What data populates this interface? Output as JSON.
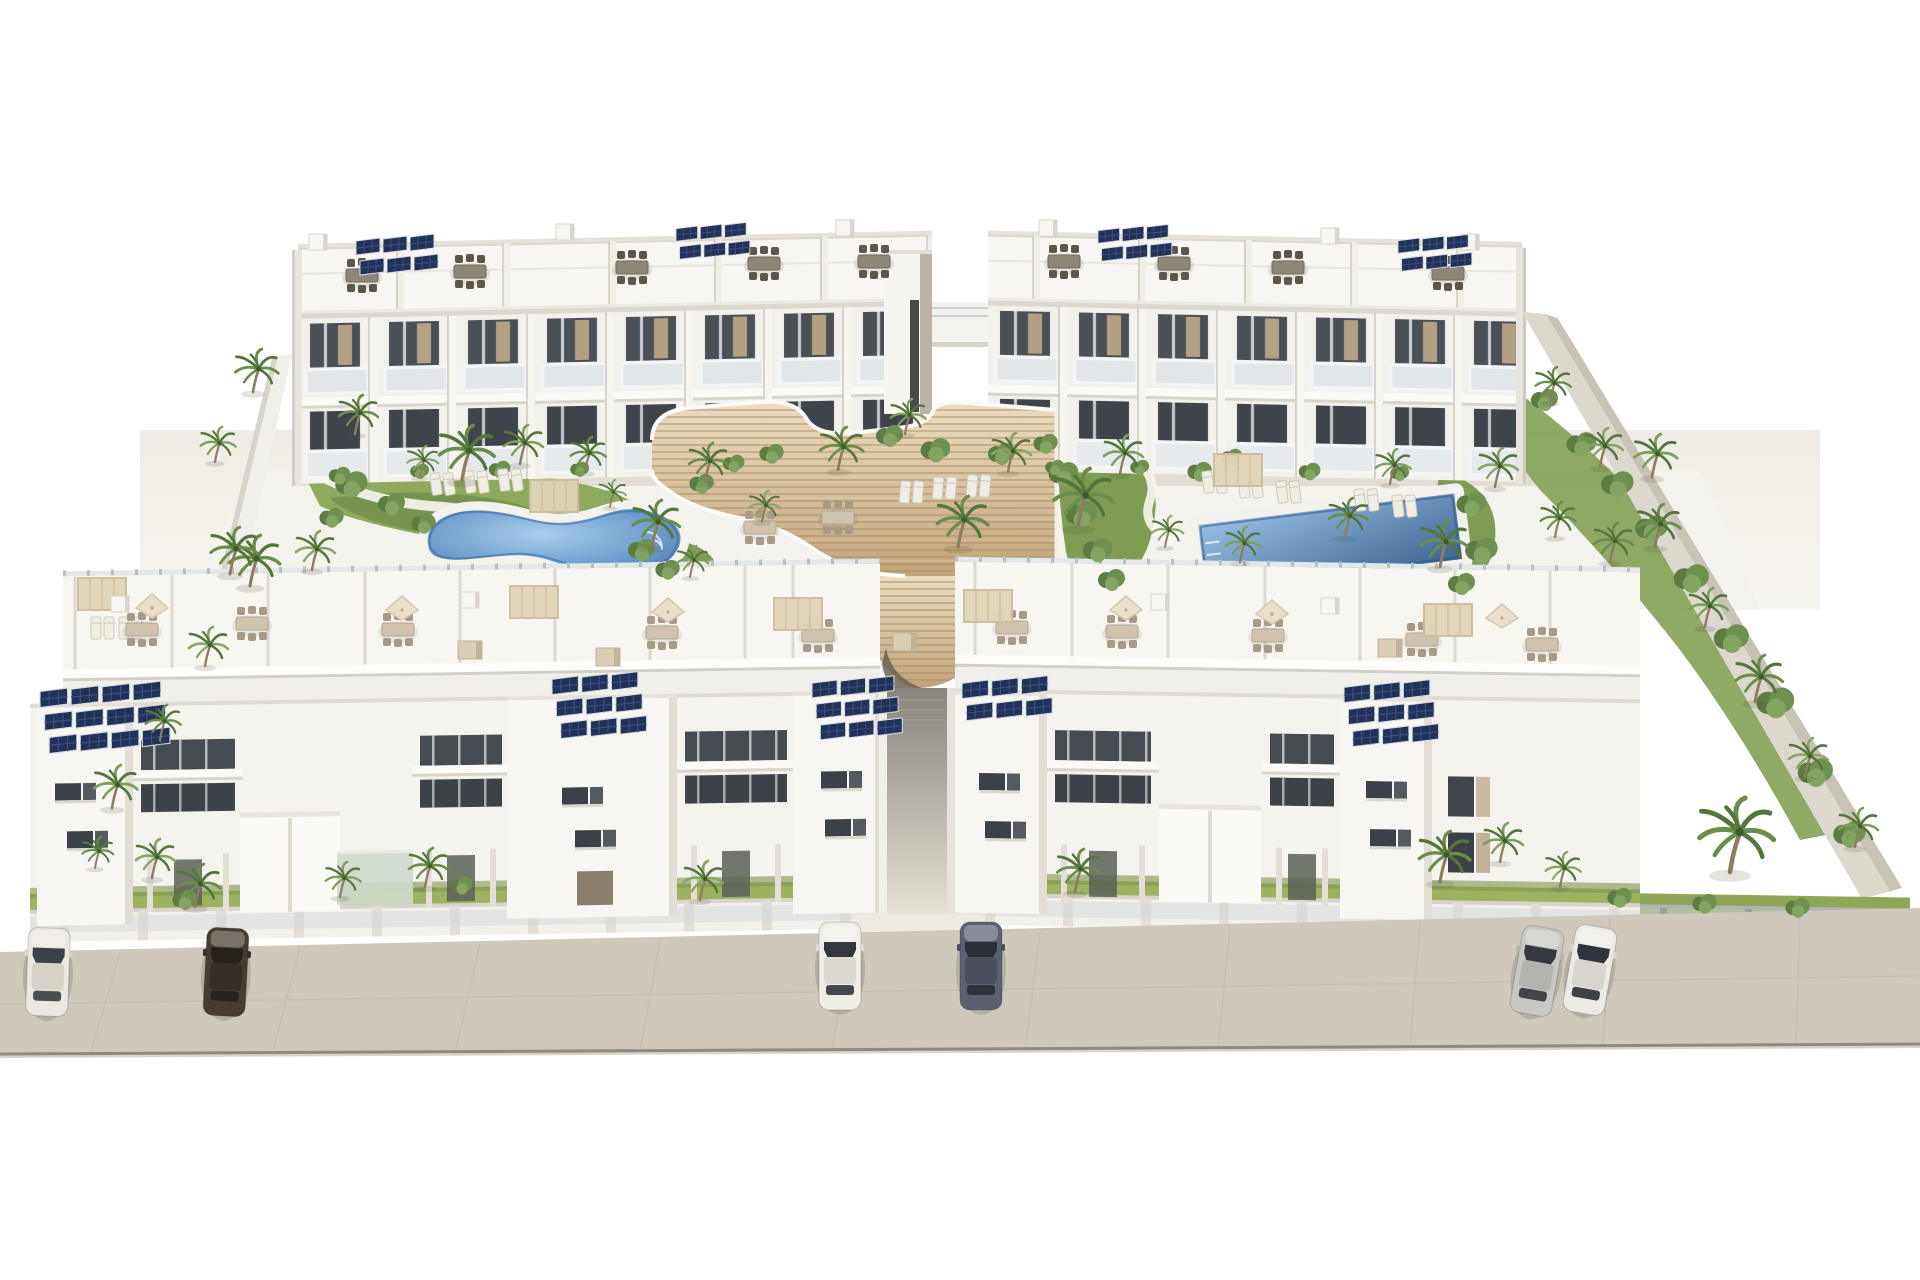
{
  "meta": {
    "description": "Aerial 3D architectural rendering of a white apartment complex with two back blocks, two front blocks, central wooden amphitheater stairs, two swimming pools, palm garden and street parking",
    "visible_text": []
  },
  "palette": {
    "sky": "#ffffff",
    "wall_white": "#f6f4f0",
    "wall_shade": "#e7e4dd",
    "wall_dark_face": "#d8d4cb",
    "opening_dark": "#41464c",
    "glass_rail": "#dfe4e6",
    "wood_light": "#e9d9bc",
    "wood_dark": "#c4a67e",
    "wood_line": "#a98f69",
    "pool_light": "#a9cdec",
    "pool_deep": "#41699b",
    "road": "#cfc8bc",
    "road_edge": "#8f8a80",
    "grass": "#97ad5e",
    "palm_green": "#6b8d4c",
    "palm_dark": "#55763b",
    "solar_panel": "#223257",
    "solar_grid": "#3c4f86"
  },
  "scene": {
    "cars": [
      {
        "name": "white-sedan-far-left",
        "x": 48,
        "y": 972,
        "rot": 2,
        "body": "#ece8e0",
        "roof": "#d6d2c8",
        "glass": "#3c4147"
      },
      {
        "name": "dark-brown-sedan-left",
        "x": 226,
        "y": 972,
        "rot": 3,
        "body": "#463c33",
        "roof": "#352d26",
        "glass": "#26211c"
      },
      {
        "name": "white-sedan-center",
        "x": 840,
        "y": 966,
        "rot": 0,
        "body": "#f0ede7",
        "roof": "#dcd8d0",
        "glass": "#34383e"
      },
      {
        "name": "slate-blue-sedan-center",
        "x": 981,
        "y": 966,
        "rot": 0,
        "body": "#5a6170",
        "roof": "#49505e",
        "glass": "#2b2f36"
      },
      {
        "name": "silver-sedan-right",
        "x": 1537,
        "y": 971,
        "rot": 10,
        "body": "#c9c8c4",
        "roof": "#b4b3af",
        "glass": "#35393f"
      },
      {
        "name": "white-sedan-right",
        "x": 1590,
        "y": 970,
        "rot": 10,
        "body": "#eceae5",
        "roof": "#d8d5cf",
        "glass": "#2f333a"
      }
    ],
    "solar_arrays": [
      {
        "x": 356,
        "y": 238,
        "cols": 3,
        "rows": 2,
        "s": 1.0
      },
      {
        "x": 676,
        "y": 226,
        "cols": 3,
        "rows": 2,
        "s": 0.9
      },
      {
        "x": 1098,
        "y": 228,
        "cols": 3,
        "rows": 2,
        "s": 0.9
      },
      {
        "x": 1398,
        "y": 238,
        "cols": 3,
        "rows": 2,
        "s": 0.9
      },
      {
        "x": 40,
        "y": 688,
        "cols": 4,
        "rows": 3,
        "s": 1.15
      },
      {
        "x": 552,
        "y": 676,
        "cols": 3,
        "rows": 3,
        "s": 1.1
      },
      {
        "x": 812,
        "y": 680,
        "cols": 3,
        "rows": 3,
        "s": 1.05
      },
      {
        "x": 962,
        "y": 680,
        "cols": 3,
        "rows": 2,
        "s": 1.1
      },
      {
        "x": 1344,
        "y": 684,
        "cols": 3,
        "rows": 3,
        "s": 1.1
      }
    ],
    "roof_furniture_dark": [
      {
        "x": 362,
        "y": 276
      },
      {
        "x": 470,
        "y": 272
      },
      {
        "x": 632,
        "y": 268
      },
      {
        "x": 764,
        "y": 264
      },
      {
        "x": 874,
        "y": 262
      },
      {
        "x": 1064,
        "y": 262
      },
      {
        "x": 1174,
        "y": 264
      },
      {
        "x": 1288,
        "y": 268
      },
      {
        "x": 1448,
        "y": 274
      }
    ],
    "roof_furniture_light": [
      {
        "x": 142,
        "y": 630
      },
      {
        "x": 252,
        "y": 624
      },
      {
        "x": 398,
        "y": 630
      },
      {
        "x": 662,
        "y": 633
      },
      {
        "x": 818,
        "y": 636
      },
      {
        "x": 1012,
        "y": 628
      },
      {
        "x": 1122,
        "y": 632
      },
      {
        "x": 1268,
        "y": 636
      },
      {
        "x": 1422,
        "y": 640
      },
      {
        "x": 1542,
        "y": 645
      },
      {
        "x": 838,
        "y": 518
      },
      {
        "x": 760,
        "y": 528
      }
    ],
    "parasols": [
      {
        "x": 152,
        "y": 608
      },
      {
        "x": 402,
        "y": 610
      },
      {
        "x": 668,
        "y": 612
      },
      {
        "x": 1126,
        "y": 610
      },
      {
        "x": 1272,
        "y": 614
      },
      {
        "x": 1502,
        "y": 618
      }
    ],
    "pergolas": [
      {
        "x": 102,
        "y": 594
      },
      {
        "x": 534,
        "y": 602
      },
      {
        "x": 798,
        "y": 614
      },
      {
        "x": 988,
        "y": 606
      },
      {
        "x": 1448,
        "y": 620
      },
      {
        "x": 554,
        "y": 496
      },
      {
        "x": 1238,
        "y": 470
      }
    ],
    "roof_boxes_white": [
      {
        "x": 318,
        "y": 242
      },
      {
        "x": 565,
        "y": 232
      },
      {
        "x": 845,
        "y": 228
      },
      {
        "x": 1048,
        "y": 228
      },
      {
        "x": 1330,
        "y": 236
      },
      {
        "x": 1470,
        "y": 242
      },
      {
        "x": 120,
        "y": 604
      },
      {
        "x": 470,
        "y": 600
      },
      {
        "x": 1160,
        "y": 602
      },
      {
        "x": 1330,
        "y": 606
      }
    ],
    "roof_boxes_tan": [
      {
        "x": 470,
        "y": 650
      },
      {
        "x": 608,
        "y": 657
      },
      {
        "x": 905,
        "y": 642
      },
      {
        "x": 1390,
        "y": 648
      }
    ],
    "loungers": [
      {
        "x": 96,
        "y": 628,
        "rot": 0
      },
      {
        "x": 124,
        "y": 628,
        "rot": 0
      },
      {
        "x": 436,
        "y": 484,
        "rot": -8
      },
      {
        "x": 470,
        "y": 482,
        "rot": -8
      },
      {
        "x": 504,
        "y": 480,
        "rot": -8
      },
      {
        "x": 905,
        "y": 492,
        "rot": 5
      },
      {
        "x": 938,
        "y": 488,
        "rot": 5
      },
      {
        "x": 972,
        "y": 486,
        "rot": 5
      },
      {
        "x": 1208,
        "y": 482,
        "rot": -7
      },
      {
        "x": 1244,
        "y": 487,
        "rot": -7
      },
      {
        "x": 1282,
        "y": 492,
        "rot": -7
      },
      {
        "x": 1360,
        "y": 500,
        "rot": -7
      },
      {
        "x": 1398,
        "y": 506,
        "rot": -7
      }
    ],
    "bushes": [
      {
        "x": 890,
        "y": 434,
        "s": 1.0
      },
      {
        "x": 936,
        "y": 448,
        "s": 1.1
      },
      {
        "x": 1002,
        "y": 452,
        "s": 1.0
      },
      {
        "x": 1046,
        "y": 442,
        "s": 0.9
      },
      {
        "x": 1064,
        "y": 472,
        "s": 1.1
      },
      {
        "x": 1082,
        "y": 512,
        "s": 1.2
      },
      {
        "x": 1098,
        "y": 548,
        "s": 1.1
      },
      {
        "x": 1112,
        "y": 578,
        "s": 1.0
      },
      {
        "x": 1200,
        "y": 470,
        "s": 0.9
      },
      {
        "x": 1232,
        "y": 456,
        "s": 0.8
      },
      {
        "x": 1472,
        "y": 502,
        "s": 1.1
      },
      {
        "x": 1482,
        "y": 548,
        "s": 1.2
      },
      {
        "x": 1462,
        "y": 582,
        "s": 1.0
      },
      {
        "x": 352,
        "y": 482,
        "s": 1.2
      },
      {
        "x": 392,
        "y": 502,
        "s": 1.0
      },
      {
        "x": 424,
        "y": 522,
        "s": 0.9
      },
      {
        "x": 332,
        "y": 516,
        "s": 0.9
      },
      {
        "x": 642,
        "y": 548,
        "s": 1.0
      },
      {
        "x": 668,
        "y": 568,
        "s": 0.9
      },
      {
        "x": 702,
        "y": 482,
        "s": 0.9
      },
      {
        "x": 734,
        "y": 462,
        "s": 0.8
      },
      {
        "x": 772,
        "y": 452,
        "s": 0.9
      },
      {
        "x": 1545,
        "y": 398,
        "s": 1.0
      },
      {
        "x": 1582,
        "y": 442,
        "s": 1.1
      },
      {
        "x": 1618,
        "y": 482,
        "s": 1.2
      },
      {
        "x": 1652,
        "y": 526,
        "s": 1.2
      },
      {
        "x": 1692,
        "y": 576,
        "s": 1.3
      },
      {
        "x": 1732,
        "y": 636,
        "s": 1.3
      },
      {
        "x": 1776,
        "y": 700,
        "s": 1.4
      },
      {
        "x": 1816,
        "y": 770,
        "s": 1.3
      },
      {
        "x": 1850,
        "y": 832,
        "s": 1.2
      },
      {
        "x": 340,
        "y": 474,
        "s": 0.8
      },
      {
        "x": 420,
        "y": 470,
        "s": 0.7
      },
      {
        "x": 500,
        "y": 468,
        "s": 0.8
      },
      {
        "x": 580,
        "y": 468,
        "s": 0.7
      },
      {
        "x": 1055,
        "y": 466,
        "s": 0.7
      },
      {
        "x": 1140,
        "y": 466,
        "s": 0.7
      },
      {
        "x": 1310,
        "y": 470,
        "s": 0.8
      },
      {
        "x": 1400,
        "y": 472,
        "s": 0.7
      },
      {
        "x": 185,
        "y": 898,
        "s": 0.9
      },
      {
        "x": 462,
        "y": 884,
        "s": 0.8
      },
      {
        "x": 1620,
        "y": 896,
        "s": 0.9
      },
      {
        "x": 1705,
        "y": 902,
        "s": 0.9
      },
      {
        "x": 1798,
        "y": 906,
        "s": 0.9
      }
    ],
    "palms": [
      {
        "x": 253,
        "y": 392,
        "s": 1.1,
        "c": "#6b8d4c"
      },
      {
        "x": 215,
        "y": 462,
        "s": 0.9,
        "c": "#7d9f5c"
      },
      {
        "x": 250,
        "y": 586,
        "s": 1.3,
        "c": "#6b8d4c"
      },
      {
        "x": 205,
        "y": 666,
        "s": 1.0,
        "c": "#86a763"
      },
      {
        "x": 160,
        "y": 740,
        "s": 0.9,
        "c": "#6b8d4c"
      },
      {
        "x": 112,
        "y": 808,
        "s": 1.1,
        "c": "#7d9f5c"
      },
      {
        "x": 95,
        "y": 868,
        "s": 0.8,
        "c": "#6b8d4c"
      },
      {
        "x": 152,
        "y": 878,
        "s": 1.0,
        "c": "#86a763"
      },
      {
        "x": 355,
        "y": 434,
        "s": 1.0,
        "c": "#6b8d4c"
      },
      {
        "x": 420,
        "y": 477,
        "s": 0.8,
        "c": "#86a763"
      },
      {
        "x": 462,
        "y": 480,
        "s": 1.4,
        "c": "#6b8d4c"
      },
      {
        "x": 520,
        "y": 464,
        "s": 1.0,
        "c": "#7d9f5c"
      },
      {
        "x": 585,
        "y": 472,
        "s": 0.9,
        "c": "#6b8d4c"
      },
      {
        "x": 610,
        "y": 507,
        "s": 0.7,
        "c": "#86a763"
      },
      {
        "x": 652,
        "y": 547,
        "s": 1.2,
        "c": "#6b8d4c"
      },
      {
        "x": 690,
        "y": 577,
        "s": 0.8,
        "c": "#7d9f5c"
      },
      {
        "x": 705,
        "y": 482,
        "s": 1.0,
        "c": "#6b8d4c"
      },
      {
        "x": 762,
        "y": 522,
        "s": 0.8,
        "c": "#86a763"
      },
      {
        "x": 838,
        "y": 470,
        "s": 1.1,
        "c": "#6b8d4c"
      },
      {
        "x": 905,
        "y": 434,
        "s": 0.9,
        "c": "#7d9f5c"
      },
      {
        "x": 958,
        "y": 547,
        "s": 1.3,
        "c": "#6b8d4c"
      },
      {
        "x": 1008,
        "y": 472,
        "s": 1.0,
        "c": "#86a763"
      },
      {
        "x": 1078,
        "y": 527,
        "s": 1.5,
        "c": "#6b8d4c"
      },
      {
        "x": 1120,
        "y": 474,
        "s": 1.0,
        "c": "#7d9f5c"
      },
      {
        "x": 1165,
        "y": 547,
        "s": 0.8,
        "c": "#86a763"
      },
      {
        "x": 1345,
        "y": 537,
        "s": 1.0,
        "c": "#6b8d4c"
      },
      {
        "x": 1390,
        "y": 484,
        "s": 0.9,
        "c": "#7d9f5c"
      },
      {
        "x": 1440,
        "y": 567,
        "s": 1.2,
        "c": "#6b8d4c"
      },
      {
        "x": 1495,
        "y": 487,
        "s": 1.0,
        "c": "#86a763"
      },
      {
        "x": 1555,
        "y": 537,
        "s": 0.9,
        "c": "#6b8d4c"
      },
      {
        "x": 1652,
        "y": 477,
        "s": 1.1,
        "c": "#7d9f5c"
      },
      {
        "x": 1550,
        "y": 402,
        "s": 0.9,
        "c": "#6b8d4c"
      },
      {
        "x": 1600,
        "y": 467,
        "s": 1.0,
        "c": "#86a763"
      },
      {
        "x": 1655,
        "y": 547,
        "s": 1.1,
        "c": "#6b8d4c"
      },
      {
        "x": 1705,
        "y": 627,
        "s": 1.0,
        "c": "#7d9f5c"
      },
      {
        "x": 1755,
        "y": 702,
        "s": 1.2,
        "c": "#6b8d4c"
      },
      {
        "x": 1805,
        "y": 777,
        "s": 1.0,
        "c": "#86a763"
      },
      {
        "x": 1730,
        "y": 872,
        "s": 1.9,
        "c": "#6b8d4c"
      },
      {
        "x": 1855,
        "y": 847,
        "s": 1.0,
        "c": "#7d9f5c"
      },
      {
        "x": 195,
        "y": 907,
        "s": 1.1,
        "c": "#6b8d4c"
      },
      {
        "x": 340,
        "y": 897,
        "s": 0.9,
        "c": "#7d9f5c"
      },
      {
        "x": 425,
        "y": 887,
        "s": 1.0,
        "c": "#6b8d4c"
      },
      {
        "x": 700,
        "y": 900,
        "s": 1.0,
        "c": "#86a763"
      },
      {
        "x": 1075,
        "y": 892,
        "s": 1.1,
        "c": "#6b8d4c"
      },
      {
        "x": 1440,
        "y": 882,
        "s": 1.3,
        "c": "#6b8d4c"
      },
      {
        "x": 1500,
        "y": 862,
        "s": 1.0,
        "c": "#7d9f5c"
      },
      {
        "x": 1560,
        "y": 887,
        "s": 0.9,
        "c": "#86a763"
      },
      {
        "x": 230,
        "y": 574,
        "s": 1.2,
        "c": "#6b8d4c"
      },
      {
        "x": 312,
        "y": 570,
        "s": 1.0,
        "c": "#86a763"
      },
      {
        "x": 1240,
        "y": 562,
        "s": 0.9,
        "c": "#7d9f5c"
      },
      {
        "x": 1610,
        "y": 562,
        "s": 1.0,
        "c": "#6b8d4c"
      }
    ],
    "front_facade_left": {
      "towers": [
        {
          "x": 37,
          "w": 96,
          "win": [
            [
              18,
              770
            ],
            [
              30,
              818
            ]
          ]
        },
        {
          "x": 507,
          "w": 170,
          "win": [
            [
              55,
              782
            ],
            [
              68,
              825
            ]
          ],
          "door": {
            "dx": 70,
            "dy": 866,
            "w": 36,
            "h": 34
          }
        },
        {
          "x": 793,
          "w": 90,
          "win": [
            [
              28,
              770
            ],
            [
              32,
              818
            ]
          ]
        }
      ],
      "bands": [
        {
          "x": 133,
          "w": 110
        },
        {
          "x": 412,
          "w": 98
        },
        {
          "x": 677,
          "w": 118
        }
      ],
      "boxes": [
        {
          "x": 240,
          "w": 100,
          "y": 802,
          "h": 100
        },
        {
          "x": 337,
          "w": 76,
          "y": 842,
          "h": 54,
          "glass": true
        }
      ]
    },
    "front_facade_right": {
      "towers": [
        {
          "x": 955,
          "w": 92,
          "win": [
            [
              24,
              772
            ],
            [
              30,
              820
            ]
          ]
        },
        {
          "x": 1340,
          "w": 92,
          "win": [
            [
              26,
              774
            ],
            [
              30,
              822
            ]
          ]
        }
      ],
      "bands": [
        {
          "x": 1047,
          "w": 112
        },
        {
          "x": 1262,
          "w": 80
        }
      ],
      "boxes": [
        {
          "x": 1159,
          "w": 102,
          "y": 800,
          "h": 98
        },
        {
          "x": 1432,
          "w": 0,
          "y": 0,
          "h": 0
        }
      ]
    }
  }
}
